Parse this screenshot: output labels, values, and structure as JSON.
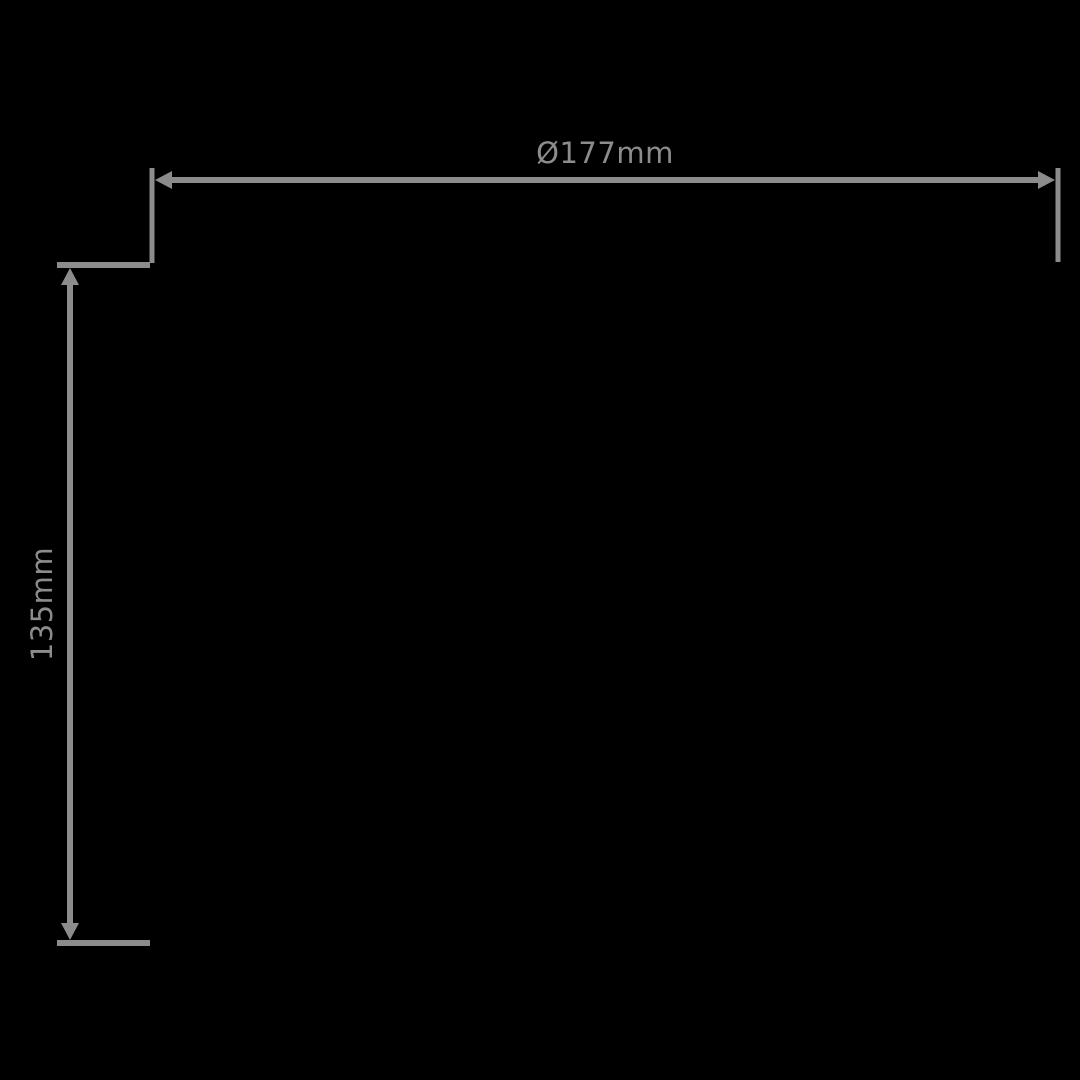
{
  "page": {
    "background": "#000000"
  },
  "drawing": {
    "type": "product-dimension-diagram",
    "line_color": "#8C8C8C",
    "text_color": "#8C8C8C",
    "dimensions": {
      "width": {
        "label": "Ø177mm",
        "orientation": "horizontal"
      },
      "height": {
        "label": "135mm",
        "orientation": "vertical"
      }
    }
  }
}
